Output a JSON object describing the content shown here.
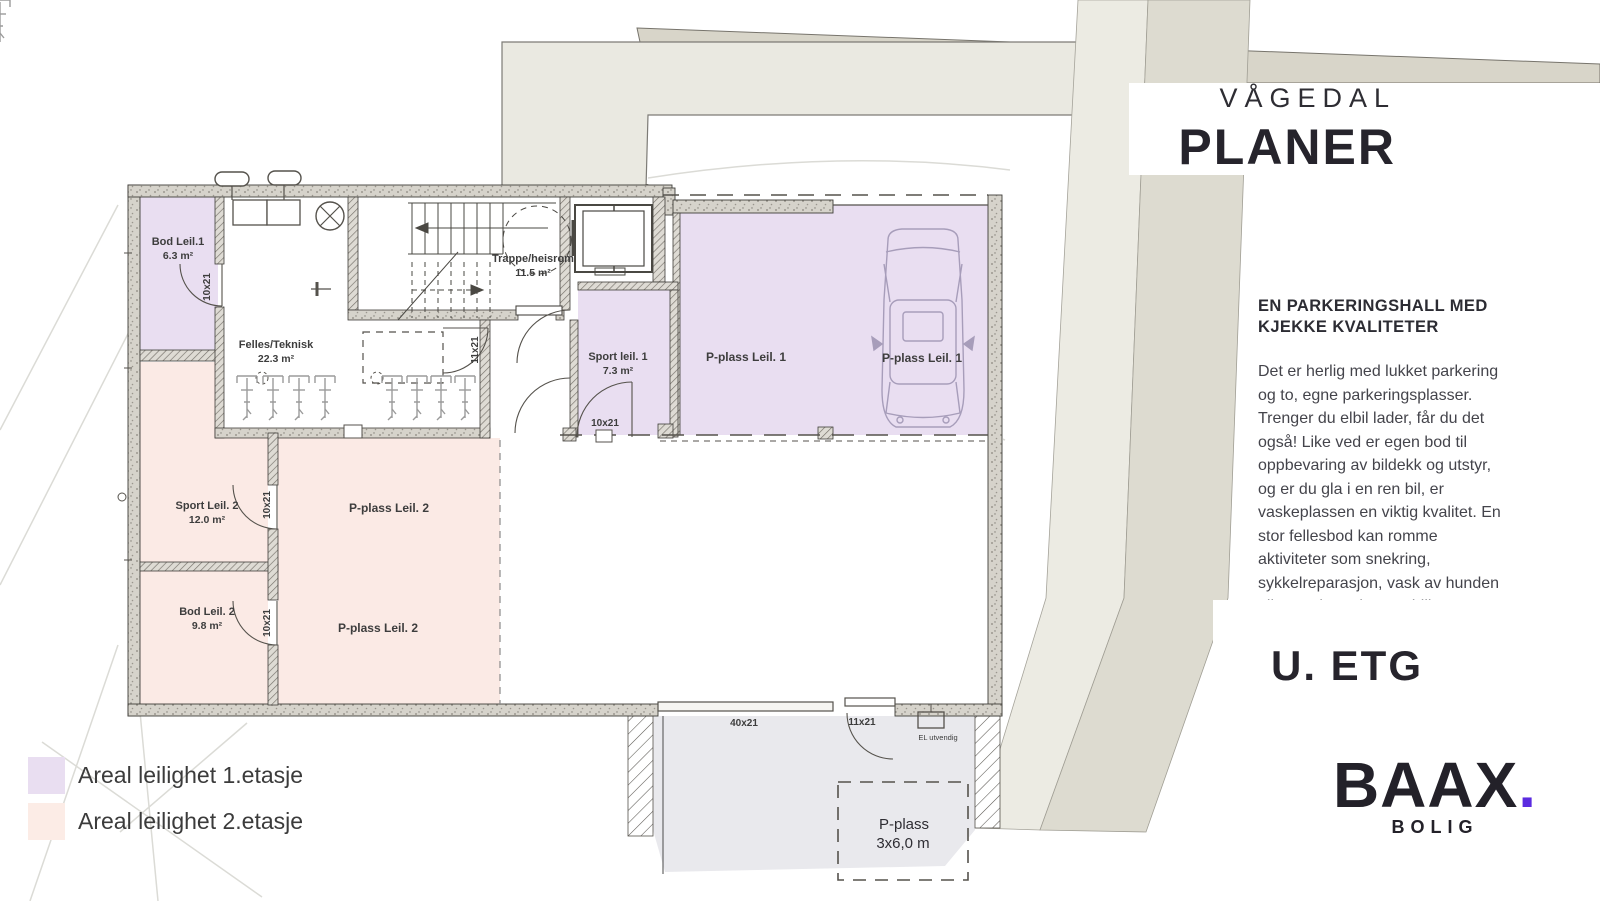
{
  "header": {
    "project": "VÅGEDAL",
    "title": "PLANER"
  },
  "info": {
    "heading": [
      "EN PARKERINGSHALL MED",
      "KJEKKE KVALITETER"
    ],
    "body_lines": [
      "Det er herlig med lukket parkering",
      "og to, egne parkeringsplasser.",
      "Trenger du elbil lader, får du det",
      "også! Like ved er egen bod til",
      "oppbevaring av bildekk og utstyr,",
      "og er du gla i en ren bil, er",
      "vaskeplassen en viktig kvalitet. En",
      "stor fellesbod kan romme",
      "aktiviteter som snekring,",
      "sykkelreparasjon, vask av hunden",
      "eller oppbevaring av drill og sag."
    ]
  },
  "floor_label": "U. ETG",
  "logo": {
    "brand": "BAAX",
    "dot": ".",
    "sub": "BOLIG"
  },
  "legend": {
    "items": [
      {
        "label": "Areal leilighet 1.etasje",
        "color": "#e9def1"
      },
      {
        "label": "Areal leilighet 2.etasje",
        "color": "#fcece6"
      }
    ]
  },
  "plan": {
    "rooms": {
      "bod1": {
        "name": "Bod Leil.1",
        "area": "6.3 m²"
      },
      "felles": {
        "name": "Felles/Teknisk",
        "area": "22.3 m²"
      },
      "trappe": {
        "name": "Trappe/heisrom",
        "area": "11.5 m²"
      },
      "sport1": {
        "name": "Sport leil. 1",
        "area": "7.3 m²"
      },
      "sport2": {
        "name": "Sport Leil. 2",
        "area": "12.0 m²"
      },
      "bod2": {
        "name": "Bod Leil. 2",
        "area": "9.8 m²"
      }
    },
    "parking": {
      "p1a": "P-plass Leil. 1",
      "p1b": "P-plass Leil. 1",
      "p2a": "P-plass Leil. 2",
      "p2b": "P-plass Leil. 2",
      "outdoor_line1": "P-plass",
      "outdoor_line2": "3x6,0 m"
    },
    "doors": {
      "bod1": "10x21",
      "sport1": "10x21",
      "sport2": "10x21",
      "bod2": "10x21",
      "corridor": "11x21",
      "entry": "11x21",
      "garage": "40x21"
    },
    "el_label": "EL utvendig"
  },
  "colors": {
    "area_floor1": "#e9def1",
    "area_floor2": "#fbeae5",
    "driveway": "#e9e9ed",
    "site_light": "#eae9e1",
    "site_band_light": "#ecebe3",
    "site_band_dark": "#dddbd0",
    "accent_dot": "#5b2be0"
  }
}
